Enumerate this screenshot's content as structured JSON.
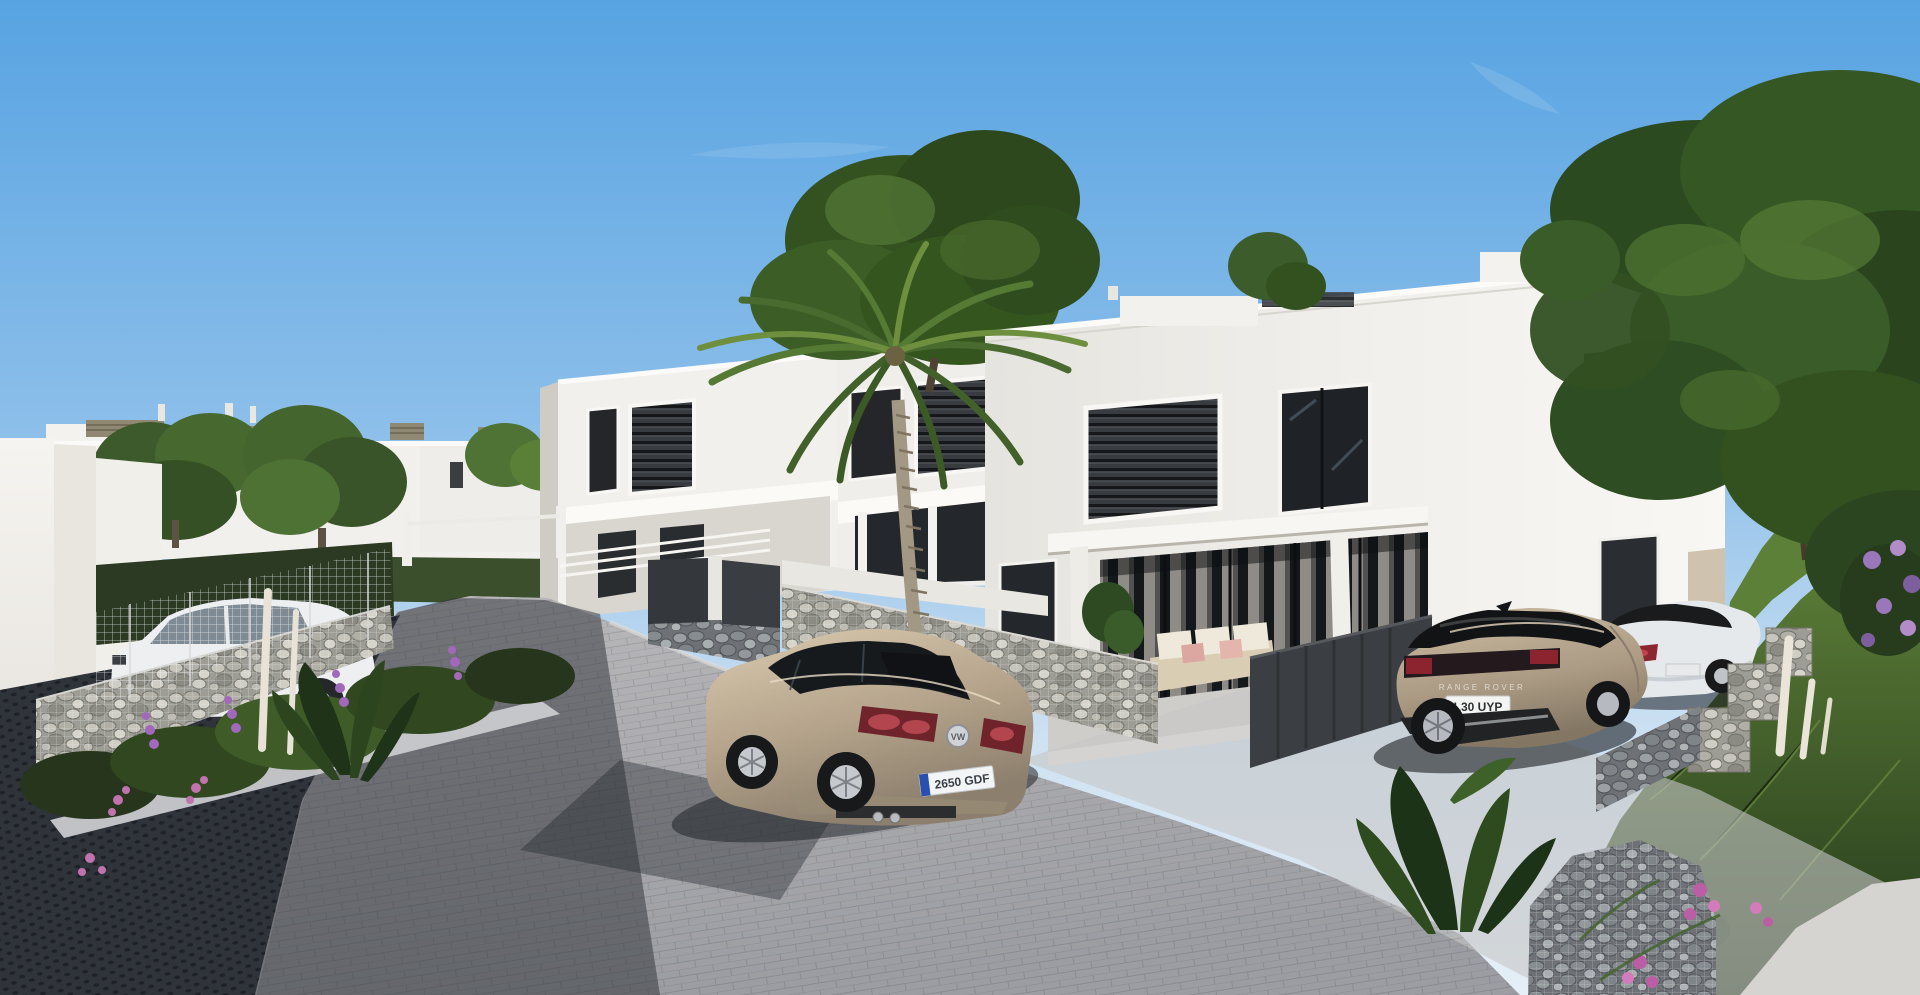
{
  "meta": {
    "title": "New-build residential development — exterior 3D render",
    "scene_type": "architectural visualization, street view of modern white villas"
  },
  "sky": {
    "top_color": "#57a3e2",
    "mid_color": "#8fc0ea",
    "horizon_color": "#e6eff7"
  },
  "environment": {
    "mountain_ridge_color": "#85796a",
    "road_color": "#a8a9ad",
    "road_shadow_color": "#2e3238",
    "paving_style": "interlocking concrete block paving",
    "gabion_stone_color": "#9aa0a3",
    "mesh_fence_color": "#eef0f1"
  },
  "buildings": {
    "left_row_label": "distant single-storey white villas with rooftop louvre vents",
    "center_duplex_label": "two-storey white townhouses with dark louvred shutters",
    "right_villa_label": "large two-storey white villa with covered terrace and outdoor sofa",
    "wall_color": "#f2f0ec",
    "window_color": "#24262a",
    "slab_color": "#fbfaf7"
  },
  "vehicles": {
    "vw_sedan": {
      "label": "champagne VW sedan on road",
      "body_color": "#b9a88e",
      "badge": "VW",
      "plate": "2650 GDF"
    },
    "range_rover": {
      "label": "champagne Range Rover with black roof in driveway",
      "body_color": "#b3a28b",
      "lettering": "RANGE ROVER",
      "plate": "L30 UYP"
    },
    "mercedes_coupe": {
      "label": "white coupe parked by villa",
      "body_color": "#e7eaed"
    },
    "hatchback": {
      "label": "white hatchback behind mesh fence",
      "body_color": "#edeff1"
    }
  },
  "landscape": {
    "palm_label": "tall palm tree",
    "big_tree_label": "large green trees",
    "gabion_label": "gabion stone retaining walls",
    "flowers": [
      "purple flower spikes",
      "pink blossoms",
      "white foxtail spikes"
    ],
    "grass_color": "#4e7030"
  }
}
